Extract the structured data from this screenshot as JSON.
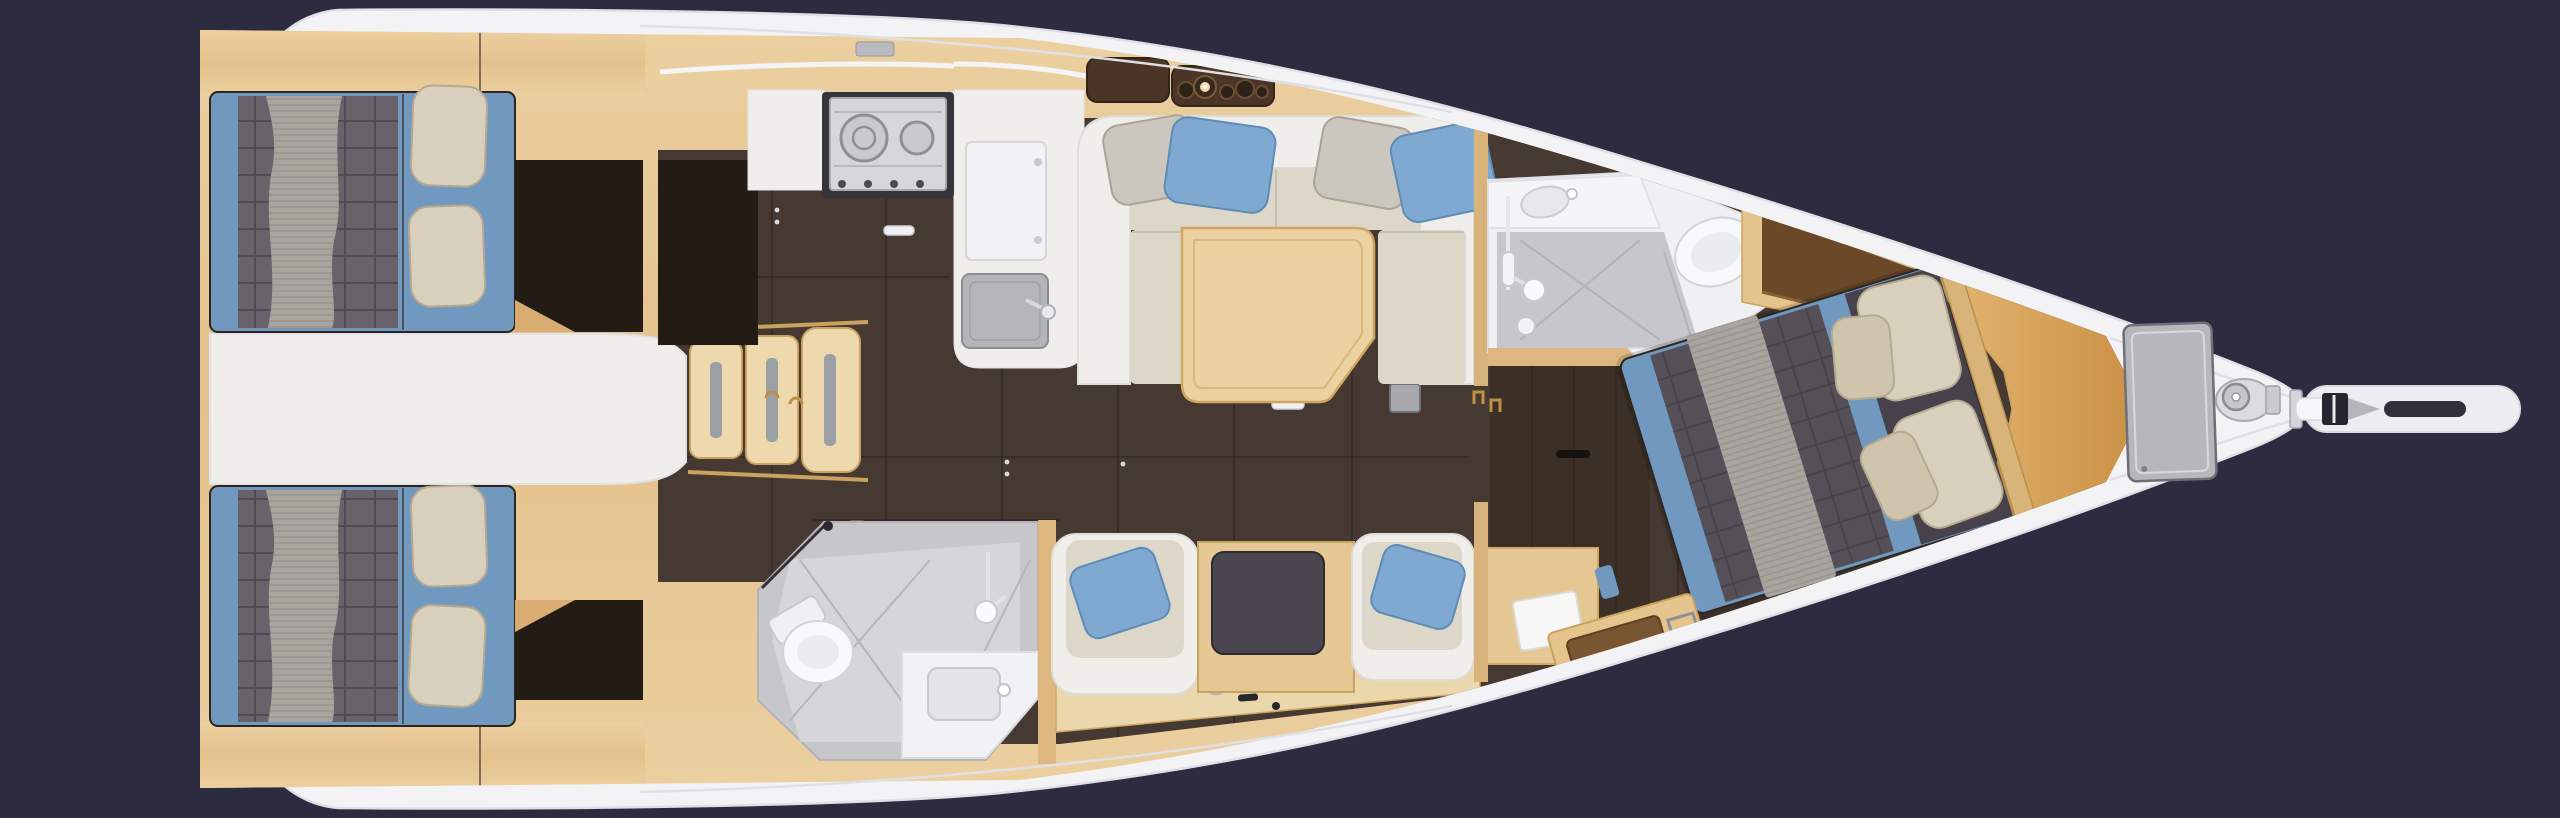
{
  "canvas": {
    "width": 2560,
    "height": 818,
    "background": "#2d2b40"
  },
  "scene": {
    "kind": "sailing-yacht-interior-floorplan",
    "view": "top-down-3d-render",
    "bow_direction": "right",
    "visible_text": ""
  },
  "palette": {
    "bg": "#2d2b40",
    "hull": "#f3f3f6",
    "hullEdge": "#dfdfe6",
    "deckSeam": "#dfdfe6",
    "woodBase": "#e6c493",
    "woodLight": "#e5c48d",
    "woodPale": "#eed9ae",
    "woodGold": "#dfae66",
    "woodTrim": "#c9a25f",
    "floor": "#463931",
    "floorFwd": "#3b2f26",
    "panelDark": "#221c15",
    "blue": "#7199bf",
    "blueDeep": "#7fa9d0",
    "duvet": "#6a626a",
    "duvetFwd": "#554f58",
    "blanket": "#aaa49f",
    "pillow": "#d8cfbc",
    "pillowShade": "#b5a98f",
    "cream": "#dcd7c9",
    "shellWhite": "#efeeea",
    "tableWood": "#ecd2a0",
    "bath": "#c7c7cb",
    "bathLight": "#d8d8dc",
    "fixture": "#f7f9fa",
    "fixtureLine": "#d0d4d8",
    "steel": "#d6d7db",
    "steelDark": "#35353b",
    "dark": "#26242f",
    "brass": "#bf8f45",
    "glow": "#f5d9a8"
  },
  "rooms": [
    {
      "id": "aft-cabin-port",
      "furniture": [
        "double-berth",
        "gray-duvet",
        "striped-blanket",
        "pillow",
        "pillow",
        "wardrobe"
      ]
    },
    {
      "id": "aft-cabin-starboard",
      "furniture": [
        "double-berth",
        "gray-duvet",
        "striped-blanket",
        "pillow",
        "pillow",
        "wardrobe"
      ]
    },
    {
      "id": "companionway",
      "furniture": [
        "engine-box",
        "step",
        "step",
        "step"
      ]
    },
    {
      "id": "galley",
      "furniture": [
        "two-burner-stove",
        "sink",
        "fridge-lid",
        "counter"
      ]
    },
    {
      "id": "salon",
      "furniture": [
        "l-shaped-sofa",
        "dining-table",
        "gray-pillow",
        "blue-pillow",
        "gray-pillow",
        "blue-pillow",
        "bottle-rack",
        "lamp"
      ]
    },
    {
      "id": "aft-head",
      "furniture": [
        "toilet",
        "shower",
        "sink-counter"
      ]
    },
    {
      "id": "nav-seating-starboard",
      "furniture": [
        "armchair",
        "blue-pillow",
        "chart-table",
        "armchair",
        "blue-pillow",
        "cabinet"
      ]
    },
    {
      "id": "forward-head",
      "furniture": [
        "shower-pan",
        "toilet",
        "sink-counter",
        "mixer"
      ]
    },
    {
      "id": "forward-cabin",
      "furniture": [
        "island-double-berth",
        "gray-duvet",
        "striped-runner",
        "pillow",
        "pillow",
        "pillow",
        "pillow",
        "wardrobe-shelf",
        "vanity-seat"
      ]
    },
    {
      "id": "bow",
      "furniture": [
        "anchor-locker-hatch",
        "windlass",
        "bowsprit",
        "anchor-roller"
      ]
    }
  ]
}
